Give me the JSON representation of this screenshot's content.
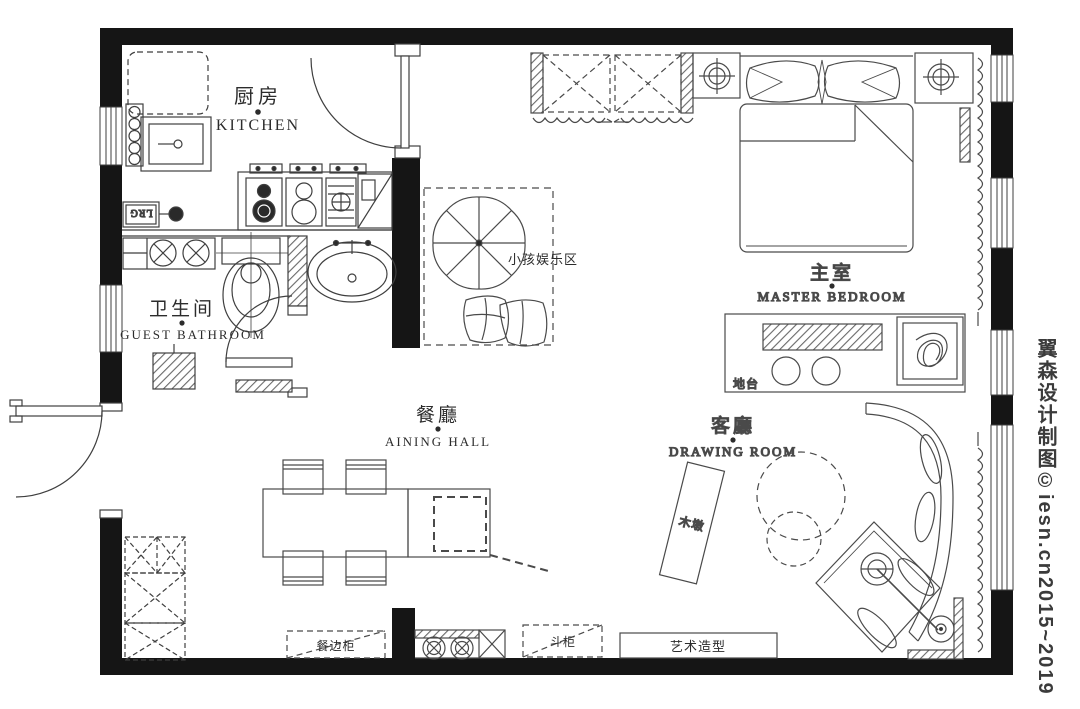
{
  "page": {
    "background": "#ffffff",
    "wall_color": "#151515",
    "line_color": "#3f3f3f",
    "hatch_color": "#555555"
  },
  "watermark": {
    "text": "翼森设计制图©iesn.cn2015~2019"
  },
  "rooms": {
    "kitchen": {
      "zh": "厨房",
      "en": "KITCHEN"
    },
    "guest_bathroom": {
      "zh": "卫生间",
      "en": "GUEST BATHROOM"
    },
    "dining_hall": {
      "zh": "餐廳",
      "en": "AINING HALL"
    },
    "master_bedroom": {
      "zh": "主室",
      "en": "MASTER BEDROOM"
    },
    "drawing_room": {
      "zh": "客廳",
      "en": "DRAWING ROOM"
    }
  },
  "annotations": {
    "kids_play_area": "小孩娱乐区",
    "platform": "地台",
    "wood_stump": "木墩",
    "sideboard": "餐边柜",
    "chest_of_drawers": "斗柜",
    "art_feature": "艺术造型",
    "appliance_label": "LRG"
  }
}
